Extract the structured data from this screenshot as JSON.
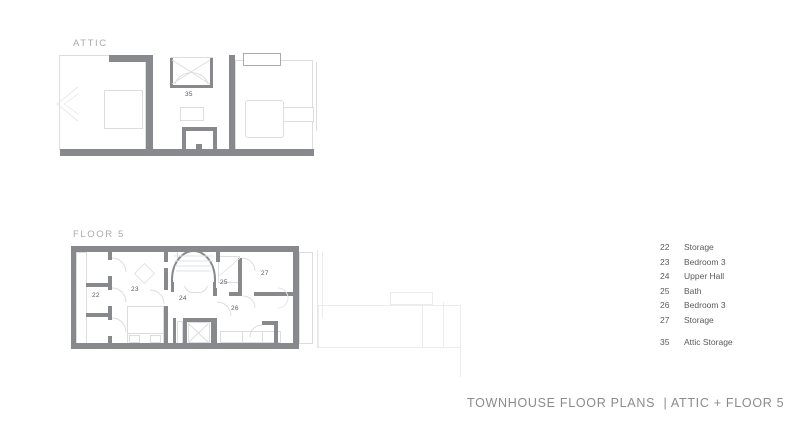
{
  "attic": {
    "label": "ATTIC",
    "rooms": [
      {
        "number": "35"
      }
    ]
  },
  "floor5": {
    "label": "FLOOR 5",
    "rooms": [
      {
        "number": "22"
      },
      {
        "number": "23"
      },
      {
        "number": "24"
      },
      {
        "number": "25"
      },
      {
        "number": "26"
      },
      {
        "number": "27"
      }
    ]
  },
  "legend": {
    "floor_items": [
      {
        "number": "22",
        "name": "Storage"
      },
      {
        "number": "23",
        "name": "Bedroom 3"
      },
      {
        "number": "24",
        "name": "Upper Hall"
      },
      {
        "number": "25",
        "name": "Bath"
      },
      {
        "number": "26",
        "name": "Bedroom 3"
      },
      {
        "number": "27",
        "name": "Storage"
      }
    ],
    "attic_items": [
      {
        "number": "35",
        "name": "Attic Storage"
      }
    ]
  },
  "footer": {
    "title": "TOWNHOUSE FLOOR PLANS  | ATTIC + FLOOR 5"
  },
  "colors": {
    "wall": "#87898c",
    "light_outline": "#dcddde",
    "faint_outline": "#ececed",
    "text_dark": "#595a5d",
    "text_light": "#a8a9ac"
  }
}
